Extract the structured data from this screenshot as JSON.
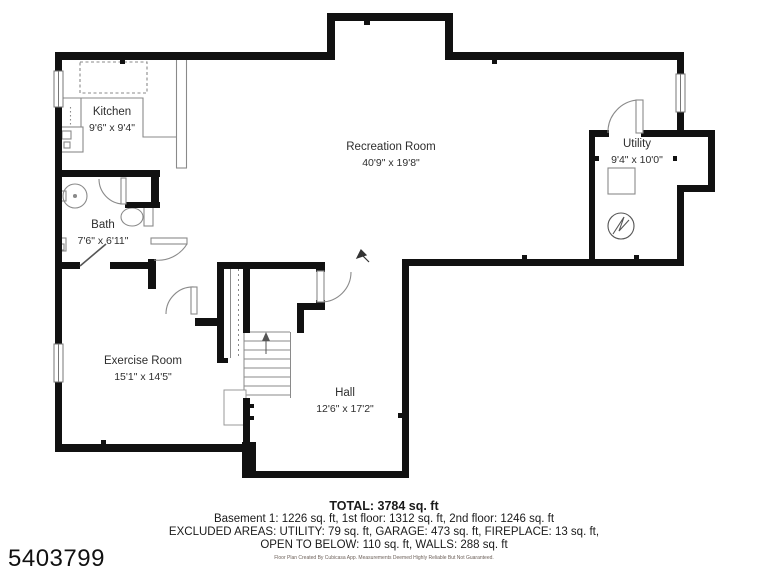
{
  "page": {
    "background": "#ffffff",
    "wall_color": "#111111",
    "fixture_line_color": "#8a8a8a"
  },
  "listing_id": "5403799",
  "floorplan": {
    "rooms": [
      {
        "id": "kitchen",
        "name": "Kitchen",
        "dimensions": "9'6\" x 9'4\""
      },
      {
        "id": "recreation",
        "name": "Recreation Room",
        "dimensions": "40'9\" x 19'8\""
      },
      {
        "id": "utility",
        "name": "Utility",
        "dimensions": "9'4\" x 10'0\""
      },
      {
        "id": "bath",
        "name": "Bath",
        "dimensions": "7'6\" x 6'11\""
      },
      {
        "id": "exercise",
        "name": "Exercise Room",
        "dimensions": "15'1\" x 14'5\""
      },
      {
        "id": "hall",
        "name": "Hall",
        "dimensions": "12'6\" x 17'2\""
      }
    ]
  },
  "summary": {
    "total": "TOTAL: 3784 sq. ft",
    "floors": "Basement 1: 1226 sq. ft, 1st floor: 1312 sq. ft, 2nd floor: 1246 sq. ft",
    "excluded_line1": "EXCLUDED AREAS: UTILITY: 79 sq. ft, GARAGE: 473 sq. ft, FIREPLACE: 13 sq. ft,",
    "excluded_line2": "OPEN TO BELOW: 110 sq. ft, WALLS: 288 sq. ft",
    "disclaimer": "Floor Plan Created By Cubicasa App. Measurements Deemed Highly Reliable But Not Guaranteed."
  }
}
